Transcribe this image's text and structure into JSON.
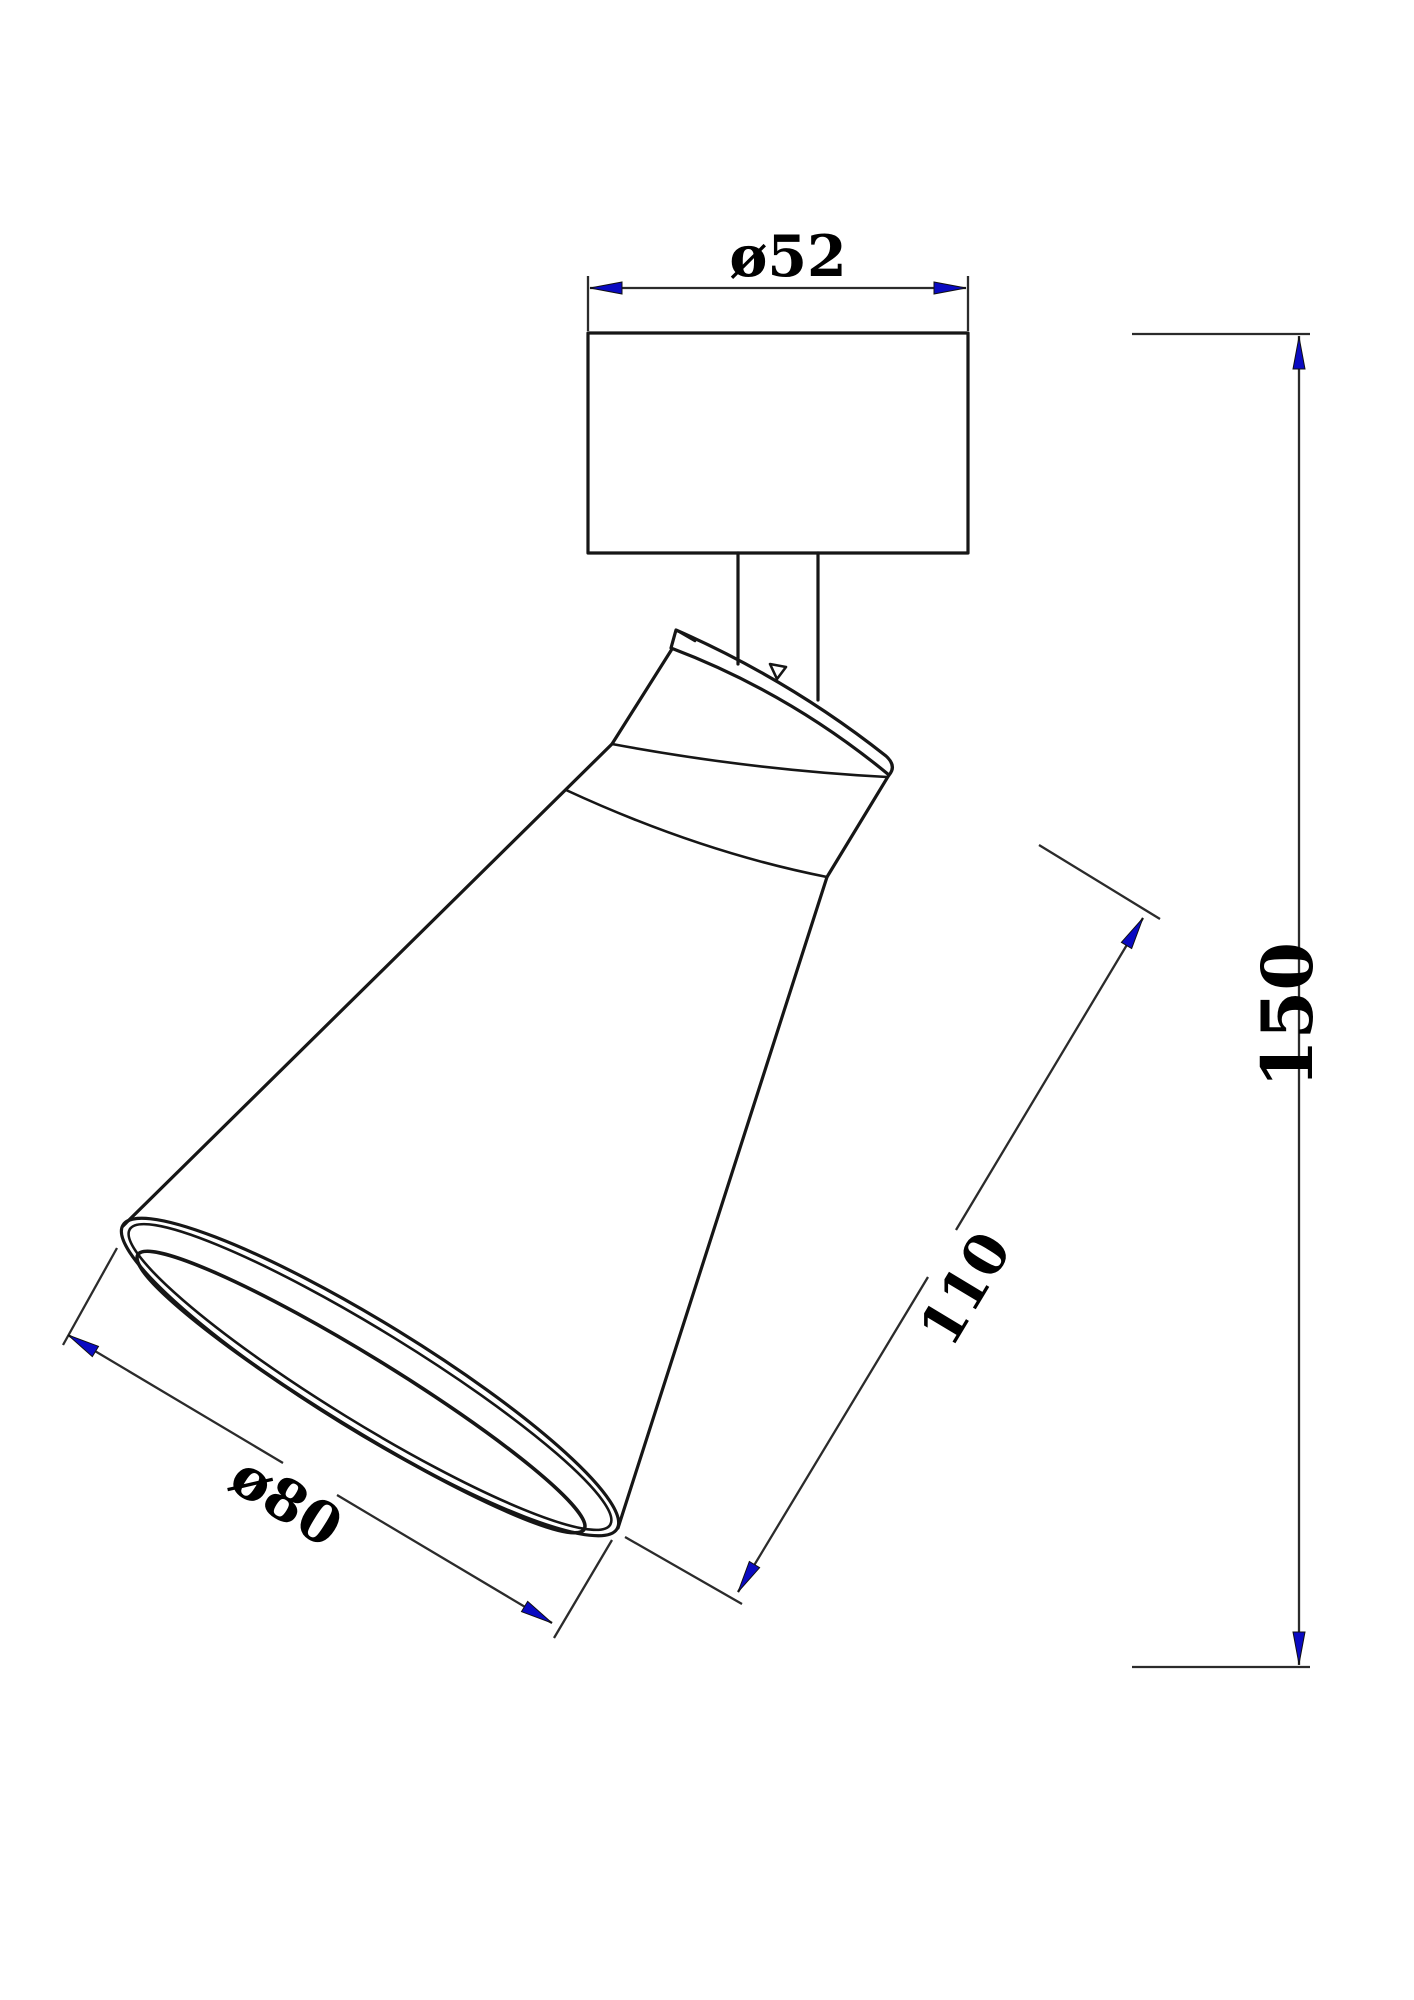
{
  "canvas": {
    "width": 1414,
    "height": 2000,
    "background": "#ffffff"
  },
  "styles": {
    "outline_color": "#161616",
    "dimension_line_color": "#2b2b2b",
    "arrowhead_color": "#0a0ac2",
    "text_color": "#000000"
  },
  "figure": {
    "description": "Side-view technical line drawing of an adjustable spotlight: rectangular cylindrical mounting base at top, short stem, tilted tapered cone shade with elliptical opening at lower left, with CAD dimension lines"
  },
  "dimensions": {
    "base_diameter": {
      "label": "ø52",
      "value": 52,
      "type": "diameter"
    },
    "overall_height": {
      "label": "150",
      "value": 150,
      "type": "linear"
    },
    "head_length": {
      "label": "110",
      "value": 110,
      "type": "linear"
    },
    "opening_diameter": {
      "label": "ø80",
      "value": 80,
      "type": "diameter"
    }
  }
}
